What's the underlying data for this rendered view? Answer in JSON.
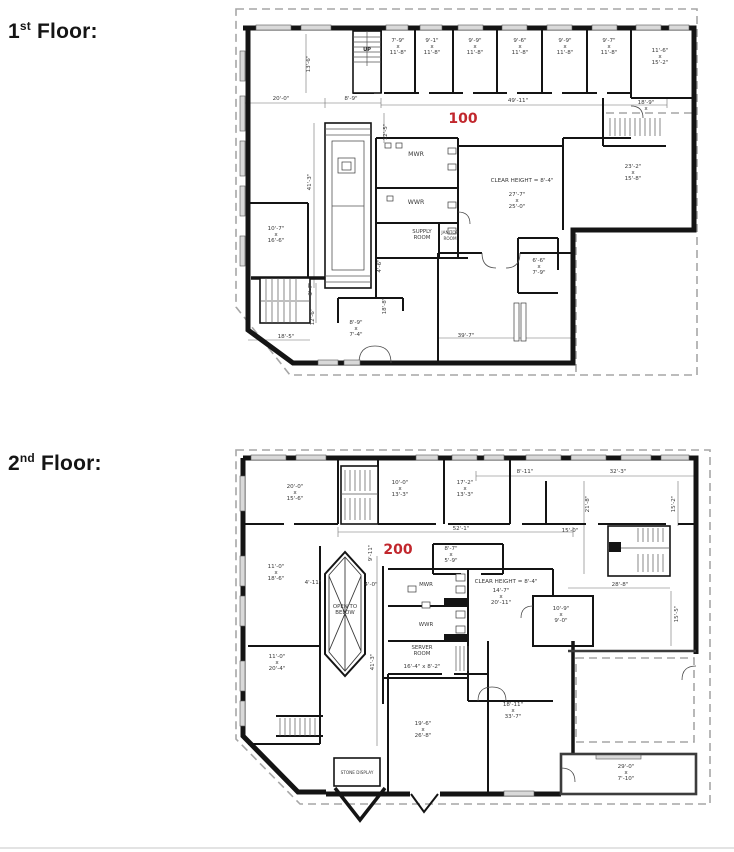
{
  "colors": {
    "suite_red": "#c1272d",
    "wall": "#141414",
    "dash_gray": "#a6a6a6"
  },
  "sections": [
    {
      "num": "1",
      "sup": "st",
      "rest": " Floor:"
    },
    {
      "num": "2",
      "sup": "nd",
      "rest": " Floor:"
    }
  ],
  "floor1": {
    "suite_number": "100",
    "labels": [
      {
        "x": 141,
        "y": 45,
        "lines": [
          "UP"
        ],
        "cls": "name-xs"
      },
      {
        "x": 84,
        "y": 58,
        "rot": -90,
        "lines": [
          "13'-6\""
        ],
        "cls": "dim"
      },
      {
        "x": 172,
        "y": 42,
        "lines": [
          "7'-9\"",
          "x",
          "11'-8\""
        ],
        "cls": "dim"
      },
      {
        "x": 206,
        "y": 42,
        "lines": [
          "9'-1\"",
          "x",
          "11'-8\""
        ],
        "cls": "dim"
      },
      {
        "x": 249,
        "y": 42,
        "lines": [
          "9'-9\"",
          "x",
          "11'-8\""
        ],
        "cls": "dim"
      },
      {
        "x": 294,
        "y": 42,
        "lines": [
          "9'-6\"",
          "x",
          "11'-8\""
        ],
        "cls": "dim"
      },
      {
        "x": 339,
        "y": 42,
        "lines": [
          "9'-9\"",
          "x",
          "11'-8\""
        ],
        "cls": "dim"
      },
      {
        "x": 383,
        "y": 42,
        "lines": [
          "9'-7\"",
          "x",
          "11'-8\""
        ],
        "cls": "dim"
      },
      {
        "x": 434,
        "y": 52,
        "lines": [
          "11'-6\"",
          "x",
          "15'-2\""
        ],
        "cls": "dim"
      },
      {
        "x": 55,
        "y": 94,
        "lines": [
          "20'-0\""
        ],
        "cls": "dim"
      },
      {
        "x": 125,
        "y": 94,
        "lines": [
          "8'-9\""
        ],
        "cls": "dim"
      },
      {
        "x": 292,
        "y": 96,
        "lines": [
          "49'-11\""
        ],
        "cls": "dim"
      },
      {
        "x": 237,
        "y": 117,
        "lines": [
          "100"
        ],
        "cls": "tag"
      },
      {
        "x": 420,
        "y": 101,
        "lines": [
          "18'-9\"",
          "x"
        ],
        "cls": "dim"
      },
      {
        "x": 161,
        "y": 126,
        "rot": -90,
        "lines": [
          "12'-5\""
        ],
        "cls": "dim"
      },
      {
        "x": 190,
        "y": 150,
        "lines": [
          "MWR"
        ],
        "cls": "name"
      },
      {
        "x": 190,
        "y": 198,
        "lines": [
          "WWR"
        ],
        "cls": "name"
      },
      {
        "x": 196,
        "y": 230,
        "lines": [
          "SUPPLY",
          "ROOM"
        ],
        "cls": "name-sm"
      },
      {
        "x": 224,
        "y": 231,
        "lines": [
          "JANITOR",
          "ROOM"
        ],
        "cls": "name-xxs"
      },
      {
        "x": 296,
        "y": 176,
        "lines": [
          "CLEAR HEIGHT = 8'-4\""
        ],
        "cls": "dim"
      },
      {
        "x": 291,
        "y": 196,
        "lines": [
          "27'-7\"",
          "x",
          "25'-0\""
        ],
        "cls": "dim"
      },
      {
        "x": 407,
        "y": 168,
        "lines": [
          "23'-2\"",
          "x",
          "15'-8\""
        ],
        "cls": "dim"
      },
      {
        "x": 50,
        "y": 230,
        "lines": [
          "10'-7\"",
          "x",
          "16'-6\""
        ],
        "cls": "dim"
      },
      {
        "x": 313,
        "y": 262,
        "lines": [
          "6'-6\"",
          "x",
          "7'-9\""
        ],
        "cls": "dim"
      },
      {
        "x": 85,
        "y": 176,
        "rot": -90,
        "lines": [
          "41'-3\""
        ],
        "cls": "dim"
      },
      {
        "x": 155,
        "y": 260,
        "rot": -90,
        "lines": [
          "4'-6\""
        ],
        "cls": "dim"
      },
      {
        "x": 160,
        "y": 300,
        "rot": -90,
        "lines": [
          "18'-8\""
        ],
        "cls": "dim"
      },
      {
        "x": 86,
        "y": 283,
        "rot": -90,
        "lines": [
          "3'-7\""
        ],
        "cls": "dim"
      },
      {
        "x": 88,
        "y": 311,
        "rot": -90,
        "lines": [
          "12'-6\""
        ],
        "cls": "dim"
      },
      {
        "x": 60,
        "y": 332,
        "lines": [
          "18'-5\""
        ],
        "cls": "dim"
      },
      {
        "x": 130,
        "y": 324,
        "lines": [
          "8'-9\"",
          "x",
          "7'-4\""
        ],
        "cls": "dim"
      },
      {
        "x": 240,
        "y": 331,
        "lines": [
          "39'-7\""
        ],
        "cls": "dim"
      }
    ]
  },
  "floor2": {
    "suite_number": "200",
    "labels": [
      {
        "x": 69,
        "y": 48,
        "lines": [
          "20'-0\"",
          "x",
          "15'-6\""
        ],
        "cls": "dim"
      },
      {
        "x": 174,
        "y": 44,
        "lines": [
          "10'-0\"",
          "x",
          "13'-3\""
        ],
        "cls": "dim"
      },
      {
        "x": 239,
        "y": 44,
        "lines": [
          "17'-2\"",
          "x",
          "13'-3\""
        ],
        "cls": "dim"
      },
      {
        "x": 299,
        "y": 27,
        "lines": [
          "8'-11\""
        ],
        "cls": "dim"
      },
      {
        "x": 392,
        "y": 27,
        "lines": [
          "32'-3\""
        ],
        "cls": "dim"
      },
      {
        "x": 235,
        "y": 84,
        "lines": [
          "52'-1\""
        ],
        "cls": "dim"
      },
      {
        "x": 363,
        "y": 58,
        "rot": -90,
        "lines": [
          "21'-8\""
        ],
        "cls": "dim"
      },
      {
        "x": 449,
        "y": 58,
        "rot": -90,
        "lines": [
          "15'-2\""
        ],
        "cls": "dim"
      },
      {
        "x": 344,
        "y": 86,
        "lines": [
          "15'-0\""
        ],
        "cls": "dim"
      },
      {
        "x": 172,
        "y": 108,
        "lines": [
          "200"
        ],
        "cls": "tag"
      },
      {
        "x": 146,
        "y": 107,
        "rot": -90,
        "lines": [
          "9'-11\""
        ],
        "cls": "dim"
      },
      {
        "x": 225,
        "y": 110,
        "lines": [
          "8'-7\"",
          "x",
          "5'-9\""
        ],
        "cls": "dim"
      },
      {
        "x": 50,
        "y": 128,
        "lines": [
          "11'-0\"",
          "x",
          "18'-6\""
        ],
        "cls": "dim"
      },
      {
        "x": 51,
        "y": 218,
        "lines": [
          "11'-0\"",
          "x",
          "20'-4\""
        ],
        "cls": "dim"
      },
      {
        "x": 119,
        "y": 165,
        "lines": [
          "OPEN TO",
          "BELOW"
        ],
        "cls": "name-sm"
      },
      {
        "x": 87,
        "y": 138,
        "lines": [
          "4'-11\""
        ],
        "cls": "dim"
      },
      {
        "x": 145,
        "y": 140,
        "lines": [
          "4'-0\""
        ],
        "cls": "dim"
      },
      {
        "x": 148,
        "y": 216,
        "rot": -90,
        "lines": [
          "41'-3\""
        ],
        "cls": "dim"
      },
      {
        "x": 200,
        "y": 140,
        "lines": [
          "MWR"
        ],
        "cls": "name-sm"
      },
      {
        "x": 200,
        "y": 180,
        "lines": [
          "WWR"
        ],
        "cls": "name-sm"
      },
      {
        "x": 196,
        "y": 206,
        "lines": [
          "SERVER",
          "ROOM"
        ],
        "cls": "name-sm"
      },
      {
        "x": 196,
        "y": 222,
        "lines": [
          "16'-4\" x 8'-2\""
        ],
        "cls": "dim"
      },
      {
        "x": 280,
        "y": 137,
        "lines": [
          "CLEAR HEIGHT = 8'-4\""
        ],
        "cls": "dim"
      },
      {
        "x": 275,
        "y": 152,
        "lines": [
          "14'-7\"",
          "x",
          "20'-11\""
        ],
        "cls": "dim"
      },
      {
        "x": 335,
        "y": 170,
        "lines": [
          "10'-9\"",
          "x",
          "9'-0\""
        ],
        "cls": "dim"
      },
      {
        "x": 394,
        "y": 140,
        "lines": [
          "28'-8\""
        ],
        "cls": "dim"
      },
      {
        "x": 452,
        "y": 168,
        "rot": -90,
        "lines": [
          "15'-5\""
        ],
        "cls": "dim"
      },
      {
        "x": 197,
        "y": 285,
        "lines": [
          "19'-6\"",
          "x",
          "26'-8\""
        ],
        "cls": "dim"
      },
      {
        "x": 287,
        "y": 266,
        "lines": [
          "18'-11\"",
          "x",
          "33'-7\""
        ],
        "cls": "dim"
      },
      {
        "x": 131,
        "y": 328,
        "lines": [
          "STONE DISPLAY"
        ],
        "cls": "name-xxs"
      },
      {
        "x": 400,
        "y": 328,
        "lines": [
          "29'-0\"",
          "x",
          "7'-10\""
        ],
        "cls": "dim"
      }
    ]
  }
}
